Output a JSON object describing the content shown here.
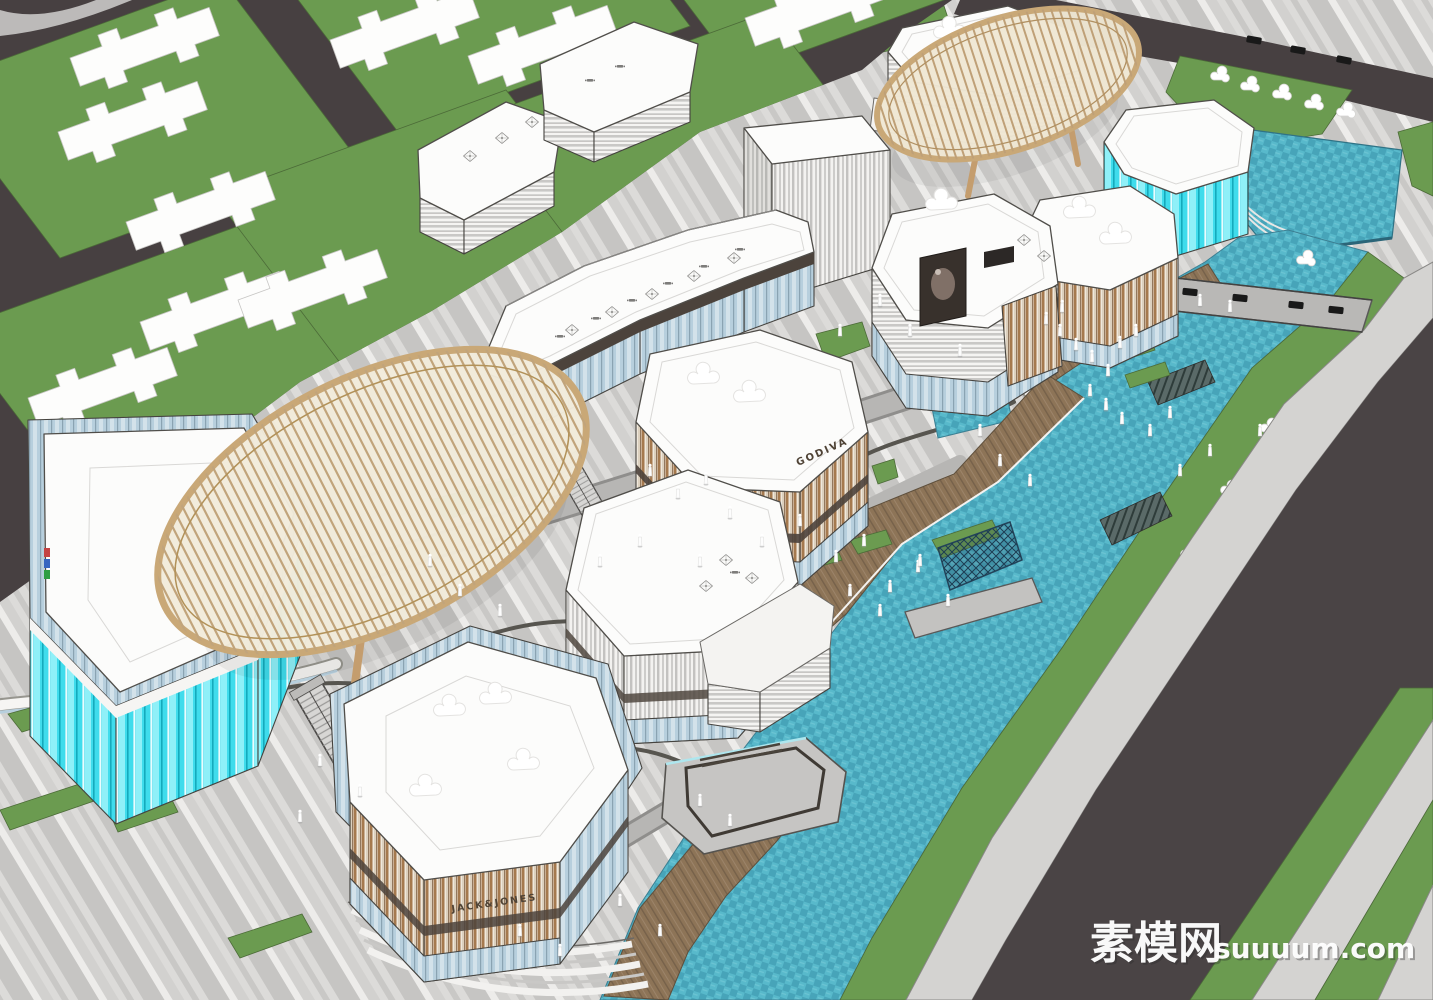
{
  "scene": {
    "watermark": {
      "cjk": "素模网",
      "latin": "suuuum.com"
    },
    "signs": {
      "foreground_building": "JACK&JONES",
      "center_building": "GODIVA"
    },
    "palette": {
      "lawn_green": "#6B9B50",
      "road_dark": "#474041",
      "asphalt": "#4A4445",
      "plaza_light": "#DCDBD9",
      "plaza_stripe": "#C6C5C3",
      "path_light": "#D4D3D1",
      "water_teal": "#4FB0C5",
      "glass_cyan": "#3FDCEC",
      "glass_blue": "#B7CFDD",
      "canopy_wood": "#C9A877",
      "facade_wood": "#A5794E",
      "deck_wood": "#8D7457",
      "roof_white": "#FCFCFB",
      "outline": "#45433F"
    }
  }
}
